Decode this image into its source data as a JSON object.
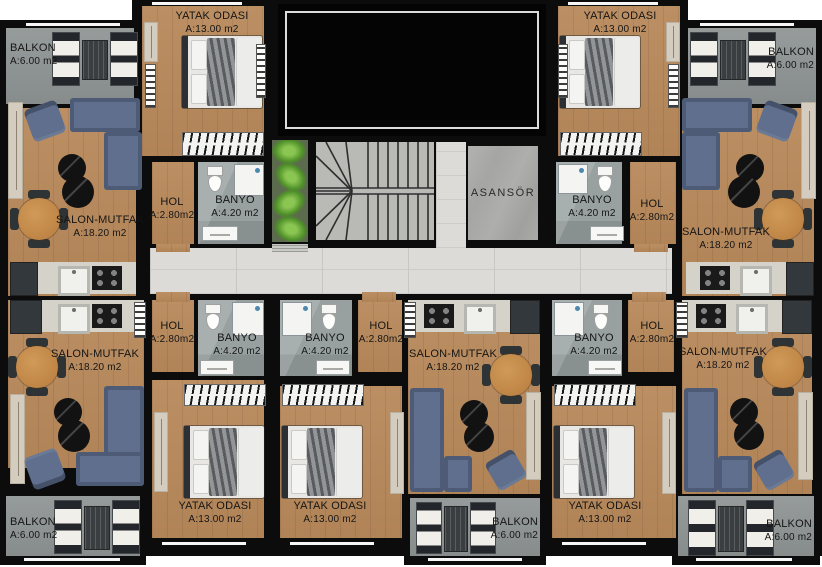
{
  "core": {
    "elevator_label": "ASANSÖR"
  },
  "apartments": {
    "top_left": {
      "balkon": {
        "name": "BALKON",
        "area": "A:6.00 m2"
      },
      "yatak": {
        "name": "YATAK ODASI",
        "area": "A:13.00 m2"
      },
      "salon": {
        "name": "SALON-MUTFAK",
        "area": "A:18.20 m2"
      },
      "hol": {
        "name": "HOL",
        "area": "A:2.80m2"
      },
      "banyo": {
        "name": "BANYO",
        "area": "A:4.20 m2"
      }
    },
    "top_right": {
      "balkon": {
        "name": "BALKON",
        "area": "A:6.00 m2"
      },
      "yatak": {
        "name": "YATAK ODASI",
        "area": "A:13.00 m2"
      },
      "salon": {
        "name": "SALON-MUTFAK",
        "area": "A:18.20 m2"
      },
      "hol": {
        "name": "HOL",
        "area": "A:2.80m2"
      },
      "banyo": {
        "name": "BANYO",
        "area": "A:4.20 m2"
      }
    },
    "bottom_left": {
      "balkon": {
        "name": "BALKON",
        "area": "A:6.00 m2"
      },
      "yatak": {
        "name": "YATAK ODASI",
        "area": "A:13.00 m2"
      },
      "salon": {
        "name": "SALON-MUTFAK",
        "area": "A:18.20 m2"
      },
      "hol": {
        "name": "HOL",
        "area": "A:2.80m2"
      },
      "banyo": {
        "name": "BANYO",
        "area": "A:4.20 m2"
      }
    },
    "bottom_middle": {
      "balkon": {
        "name": "BALKON",
        "area": "A:6.00 m2"
      },
      "yatak": {
        "name": "YATAK ODASI",
        "area": "A:13.00 m2"
      },
      "salon": {
        "name": "SALON-MUTFAK",
        "area": "A:18.20 m2"
      },
      "hol": {
        "name": "HOL",
        "area": "A:2.80m2"
      },
      "banyo": {
        "name": "BANYO",
        "area": "A:4.20 m2"
      }
    },
    "bottom_right": {
      "balkon": {
        "name": "BALKON",
        "area": "A:6.00 m2"
      },
      "yatak": {
        "name": "YATAK ODASI",
        "area": "A:13.00 m2"
      },
      "salon": {
        "name": "SALON-MUTFAK",
        "area": "A:18.20 m2"
      },
      "hol": {
        "name": "HOL",
        "area": "A:2.80m2"
      },
      "banyo": {
        "name": "BANYO",
        "area": "A:4.20 m2"
      }
    }
  },
  "colors": {
    "wall": "#0c0c0c",
    "wood": "#b8895b",
    "balcony": "#8e9493",
    "bathroom": "#98a0a0",
    "corridor": "#dcdbd7",
    "elevator": "#a8a8a8",
    "sofa": "#5f6f8d",
    "dining": "#b87c3e",
    "coffee": "#121212",
    "counter": "#d5d2ca",
    "plants": "#4e8f28",
    "window": "#f7f7f7",
    "label": "#151515"
  }
}
